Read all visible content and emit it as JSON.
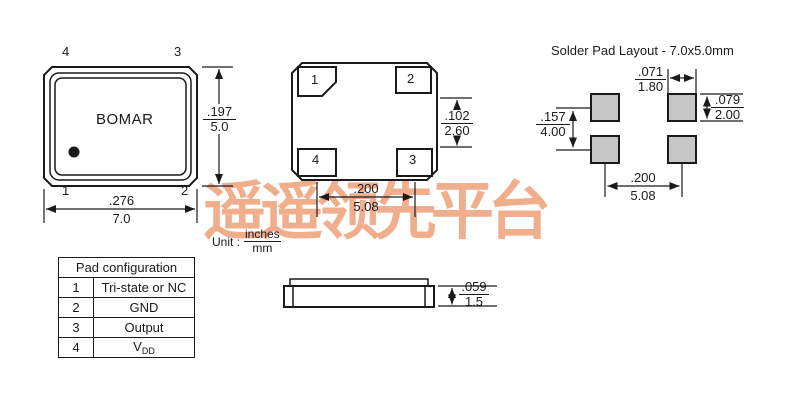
{
  "watermark": {
    "text": "遥遥领先平台",
    "color": "#f0ae8d"
  },
  "colors": {
    "line": "#1a1a1a",
    "solder_pad_fill": "#c6c6c6",
    "background": "#ffffff"
  },
  "unit_label": {
    "prefix": "Unit :",
    "numerator": "inches",
    "denominator": "mm"
  },
  "top_view": {
    "brand": "BOMAR",
    "pins": {
      "top_left": "4",
      "top_right": "3",
      "bottom_left": "1",
      "bottom_right": "2"
    },
    "dims": {
      "width": {
        "inches": ".276",
        "mm": "7.0"
      },
      "height": {
        "inches": ".197",
        "mm": "5.0"
      }
    }
  },
  "bottom_view": {
    "pads": {
      "top_left": "1",
      "top_right": "2",
      "bottom_left": "4",
      "bottom_right": "3"
    },
    "dims": {
      "pad_gap": {
        "inches": ".102",
        "mm": "2.60"
      },
      "pad_pitch": {
        "inches": ".200",
        "mm": "5.08"
      }
    }
  },
  "side_view": {
    "dims": {
      "height": {
        "inches": ".059",
        "mm": "1.5"
      }
    }
  },
  "solder_pad_layout": {
    "title": "Solder Pad Layout - 7.0x5.0mm",
    "pad_color": "#c6c6c6",
    "dims": {
      "pad_width": {
        "inches": ".071",
        "mm": "1.80"
      },
      "pad_height": {
        "inches": ".079",
        "mm": "2.00"
      },
      "vertical_pitch": {
        "inches": ".157",
        "mm": "4.00"
      },
      "horizontal_pitch": {
        "inches": ".200",
        "mm": "5.08"
      }
    }
  },
  "pad_table": {
    "title": "Pad configuration",
    "rows": [
      {
        "num": "1",
        "label": "Tri-state or NC"
      },
      {
        "num": "2",
        "label": "GND"
      },
      {
        "num": "3",
        "label": "Output"
      },
      {
        "num": "4",
        "label": "VDD",
        "label_main": "V",
        "label_sub": "DD"
      }
    ]
  }
}
